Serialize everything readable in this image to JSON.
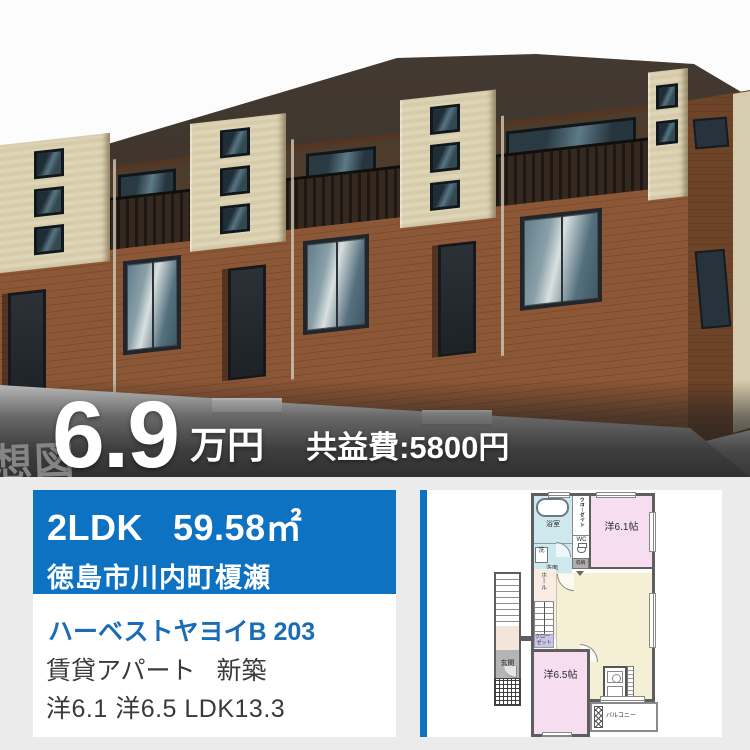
{
  "photo": {
    "watermark": "想図",
    "price": {
      "value": "6.9",
      "unit": "万円",
      "fee": "共益費:5800円"
    }
  },
  "listing": {
    "layout": "2LDK",
    "area": "59.58㎡",
    "address": "徳島市川内町榎瀬",
    "name": "ハーベストヤヨイB 203",
    "category": "賃貸アパート",
    "condition": "新築",
    "rooms": "洋6.1 洋6.5 LDK13.3"
  },
  "floorplan": {
    "bath": "浴室",
    "wash": "洗",
    "washroom": "洗面",
    "wc": "WC",
    "wic_1": "ウォークイン",
    "wic_2": "クローゼット",
    "storage": "収納",
    "room1": "洋6.1帖",
    "hall": "ホール",
    "closet_1": "クロー",
    "closet_2": "ゼット",
    "fridge": "冷",
    "ldk": "LDK",
    "ldk_size": "13.3帖",
    "room2": "洋6.5帖",
    "entrance": "玄関",
    "balcony": "バルコニー"
  },
  "colors": {
    "accent": "#0e72c3",
    "link": "#1a6cb5"
  }
}
